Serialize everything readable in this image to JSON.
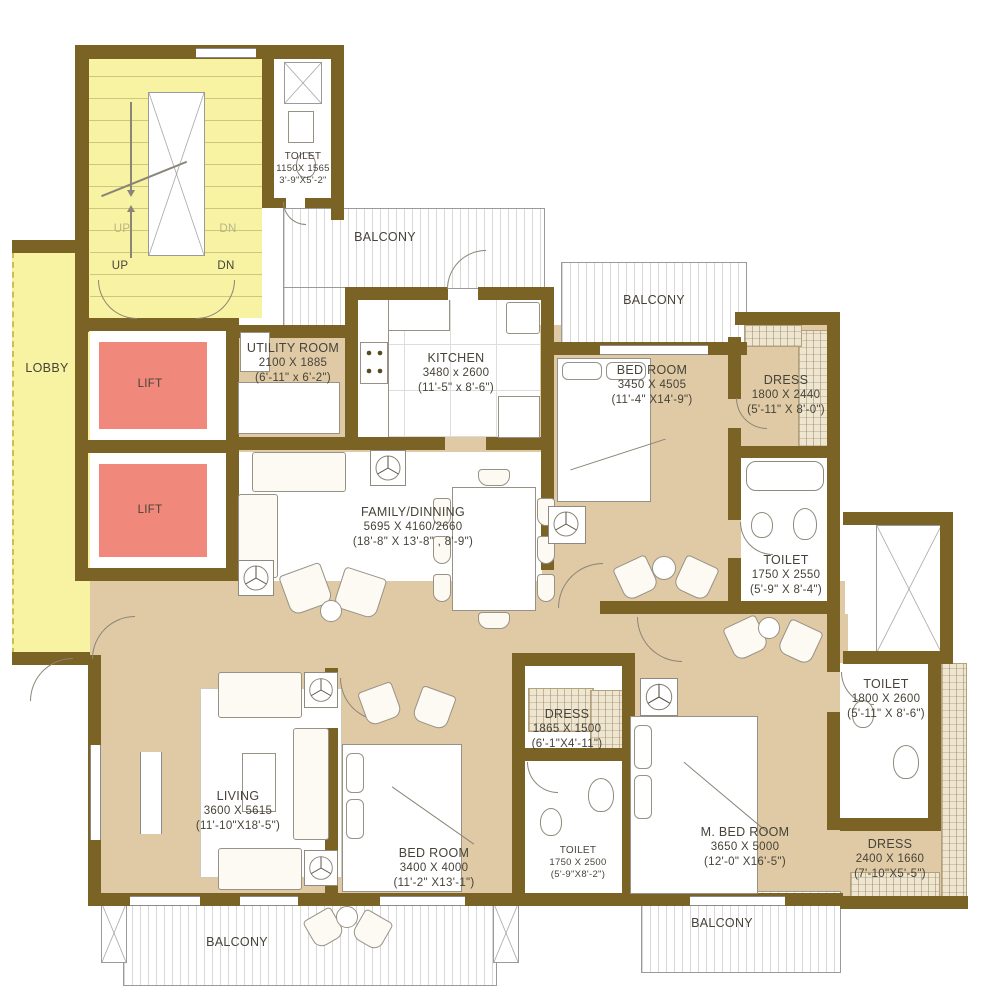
{
  "plan": {
    "rooms": {
      "toilet_top": {
        "name": "TOILET",
        "mm": "1150X 1565",
        "ft": "3'-9\"X5'-2\""
      },
      "balcony_top": {
        "name": "BALCONY"
      },
      "balcony_right": {
        "name": "BALCONY"
      },
      "utility": {
        "name": "UTILITY ROOM",
        "mm": "2100 X 1885",
        "ft": "(6'-11\" x 6'-2\")"
      },
      "kitchen": {
        "name": "KITCHEN",
        "mm": "3480 x 2600",
        "ft": "(11'-5\" x 8'-6\")"
      },
      "bedroom_top": {
        "name": "BED ROOM",
        "mm": "3450 X 4505",
        "ft": "(11'-4\" X14'-9\")"
      },
      "dress_top": {
        "name": "DRESS",
        "mm": "1800 X 2440",
        "ft": "(5'-11\" X 8'-0\")"
      },
      "family": {
        "name": "FAMILY/DINNING",
        "mm": "5695 X 4160/2660",
        "ft": "(18'-8\" X 13'-8\" , 8'-9\")"
      },
      "toilet_mid": {
        "name": "TOILET",
        "mm": "1750 X 2550",
        "ft": "(5'-9\" X 8'-4\")"
      },
      "toilet_right": {
        "name": "TOILET",
        "mm": "1800 X 2600",
        "ft": "(5'-11\" X 8'-6\")"
      },
      "dress_mid": {
        "name": "DRESS",
        "mm": "1865 X 1500",
        "ft": "(6'-1\"X4'-11\")"
      },
      "living": {
        "name": "LIVING",
        "mm": "3600 X 5615",
        "ft": "(11'-10\"X18'-5\")"
      },
      "bedroom_bottom": {
        "name": "BED ROOM",
        "mm": "3400 X 4000",
        "ft": "(11'-2\" X13'-1\")"
      },
      "toilet_bottom": {
        "name": "TOILET",
        "mm": "1750 X 2500",
        "ft": "(5'-9\"X8'-2\")"
      },
      "mbedroom": {
        "name": "M. BED ROOM",
        "mm": "3650 X 5000",
        "ft": "(12'-0\" X16'-5\")"
      },
      "dress_bottom": {
        "name": "DRESS",
        "mm": "2400 X 1660",
        "ft": "(7'-10\"X5'-5\")"
      },
      "balcony_bottom_left": {
        "name": "BALCONY"
      },
      "balcony_bottom_right": {
        "name": "BALCONY"
      },
      "lobby": {
        "name": "LOBBY"
      },
      "lift1": {
        "name": "LIFT"
      },
      "lift2": {
        "name": "LIFT"
      }
    },
    "stairs": {
      "up_inner": "UP",
      "dn_inner": "DN",
      "up_outer": "UP",
      "dn_outer": "DN"
    },
    "colors": {
      "wall": "#7a6324",
      "stair_yellow": "#f7f3a3",
      "floor_beige": "#dfcaa5",
      "lift_salmon": "#f0897b",
      "line_gray": "#9a9a9a"
    }
  }
}
